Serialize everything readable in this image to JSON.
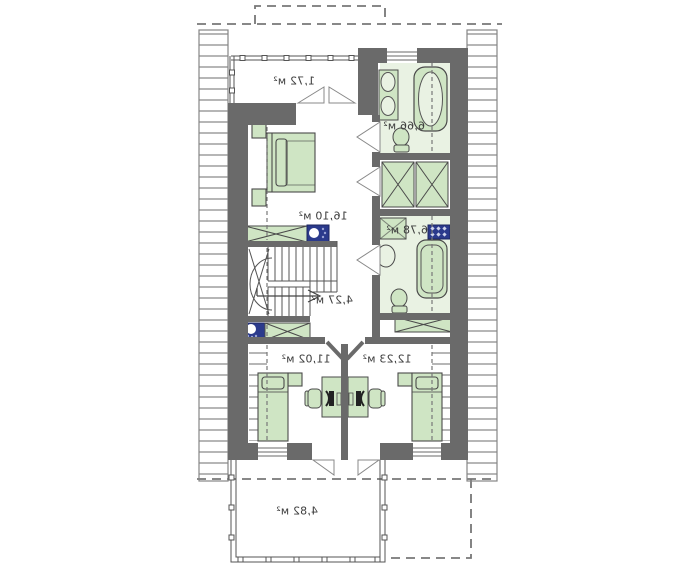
{
  "plan": {
    "type": "attic-floor-plan-mirrored",
    "rooms": {
      "balcony_top": {
        "area": "1,72 м²"
      },
      "bathroom_top": {
        "area": "6,66 м²"
      },
      "bedroom": {
        "area": "16,10 м²"
      },
      "bathroom_mid": {
        "area": "6,78 м²"
      },
      "hall": {
        "area": "4,27 м²"
      },
      "room_left": {
        "area": "11,02 м²"
      },
      "room_right": {
        "area": "12,23 м²"
      },
      "terrace": {
        "area": "4,82 м²"
      }
    },
    "colors": {
      "wall": "#6a6a6a",
      "furniture_green": "#cfe5c4",
      "floor_pale_green": "#e9f2e3",
      "navy": "#2b3a8c",
      "outline": "#4a4a4a",
      "hatch_gray": "#858585",
      "dashed_gray": "#777777",
      "background": "#ffffff"
    }
  }
}
